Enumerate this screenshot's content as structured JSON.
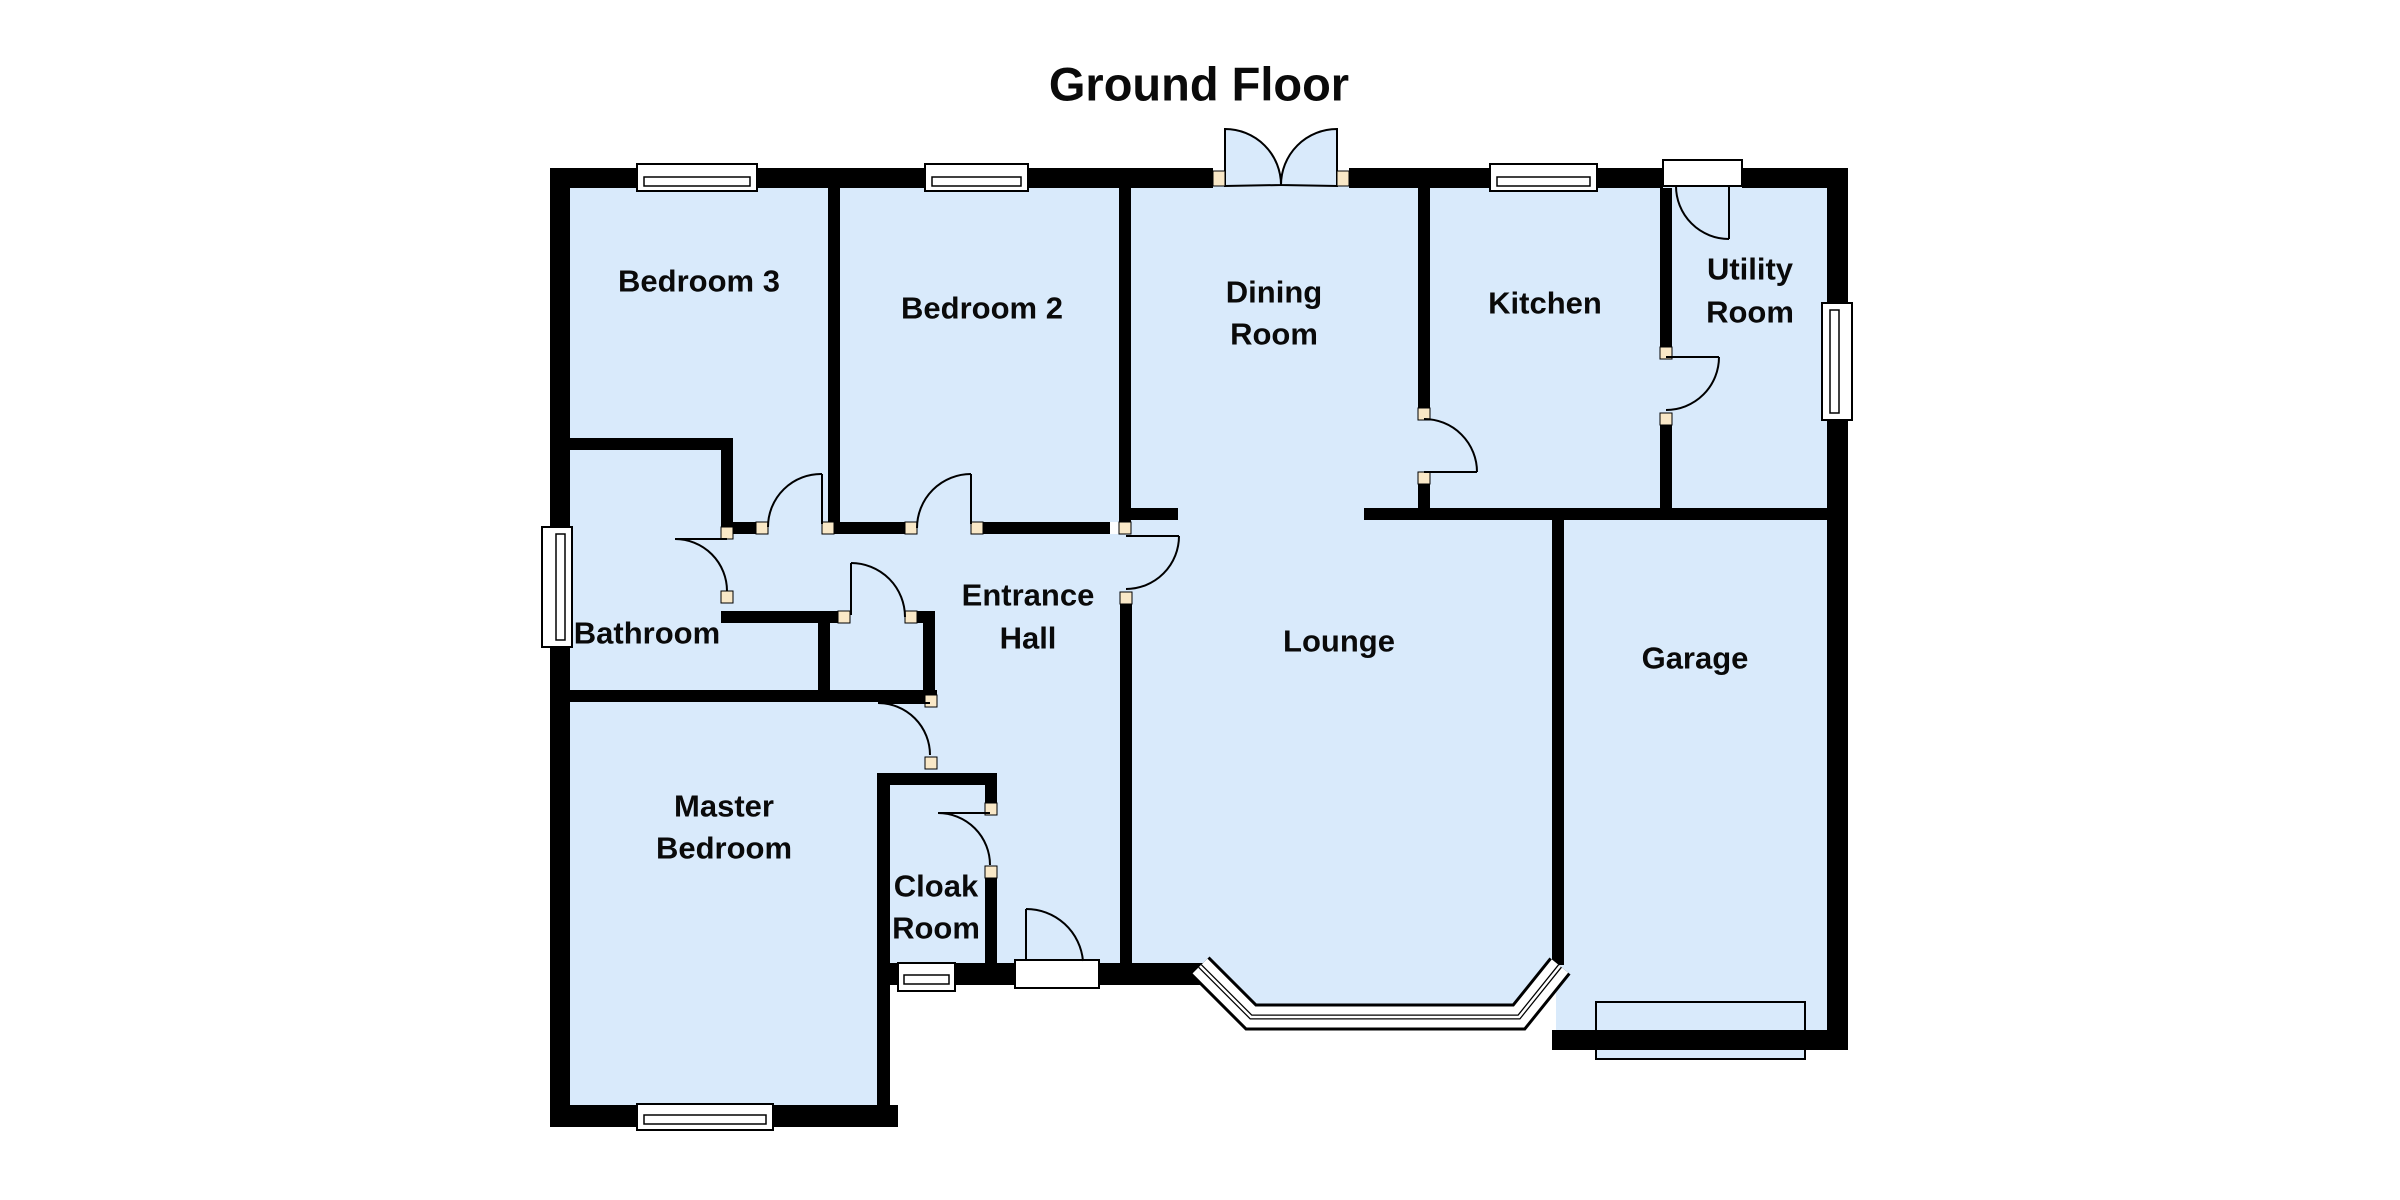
{
  "title": "Ground Floor",
  "rooms": {
    "bedroom3": {
      "label": "Bedroom 3"
    },
    "bedroom2": {
      "label": "Bedroom 2"
    },
    "dining": {
      "line1": "Dining",
      "line2": "Room"
    },
    "kitchen": {
      "label": "Kitchen"
    },
    "utility": {
      "line1": "Utility",
      "line2": "Room"
    },
    "bathroom": {
      "label": "Bathroom"
    },
    "hall": {
      "line1": "Entrance",
      "line2": "Hall"
    },
    "lounge": {
      "label": "Lounge"
    },
    "garage": {
      "label": "Garage"
    },
    "master": {
      "line1": "Master",
      "line2": "Bedroom"
    },
    "cloak": {
      "line1": "Cloak",
      "line2": "Room"
    }
  },
  "colors": {
    "floor": "#d9eafb",
    "wall": "#000000",
    "hinge": "#f9e8c7",
    "frame": "#ffffff",
    "paper": "#ffffff"
  }
}
